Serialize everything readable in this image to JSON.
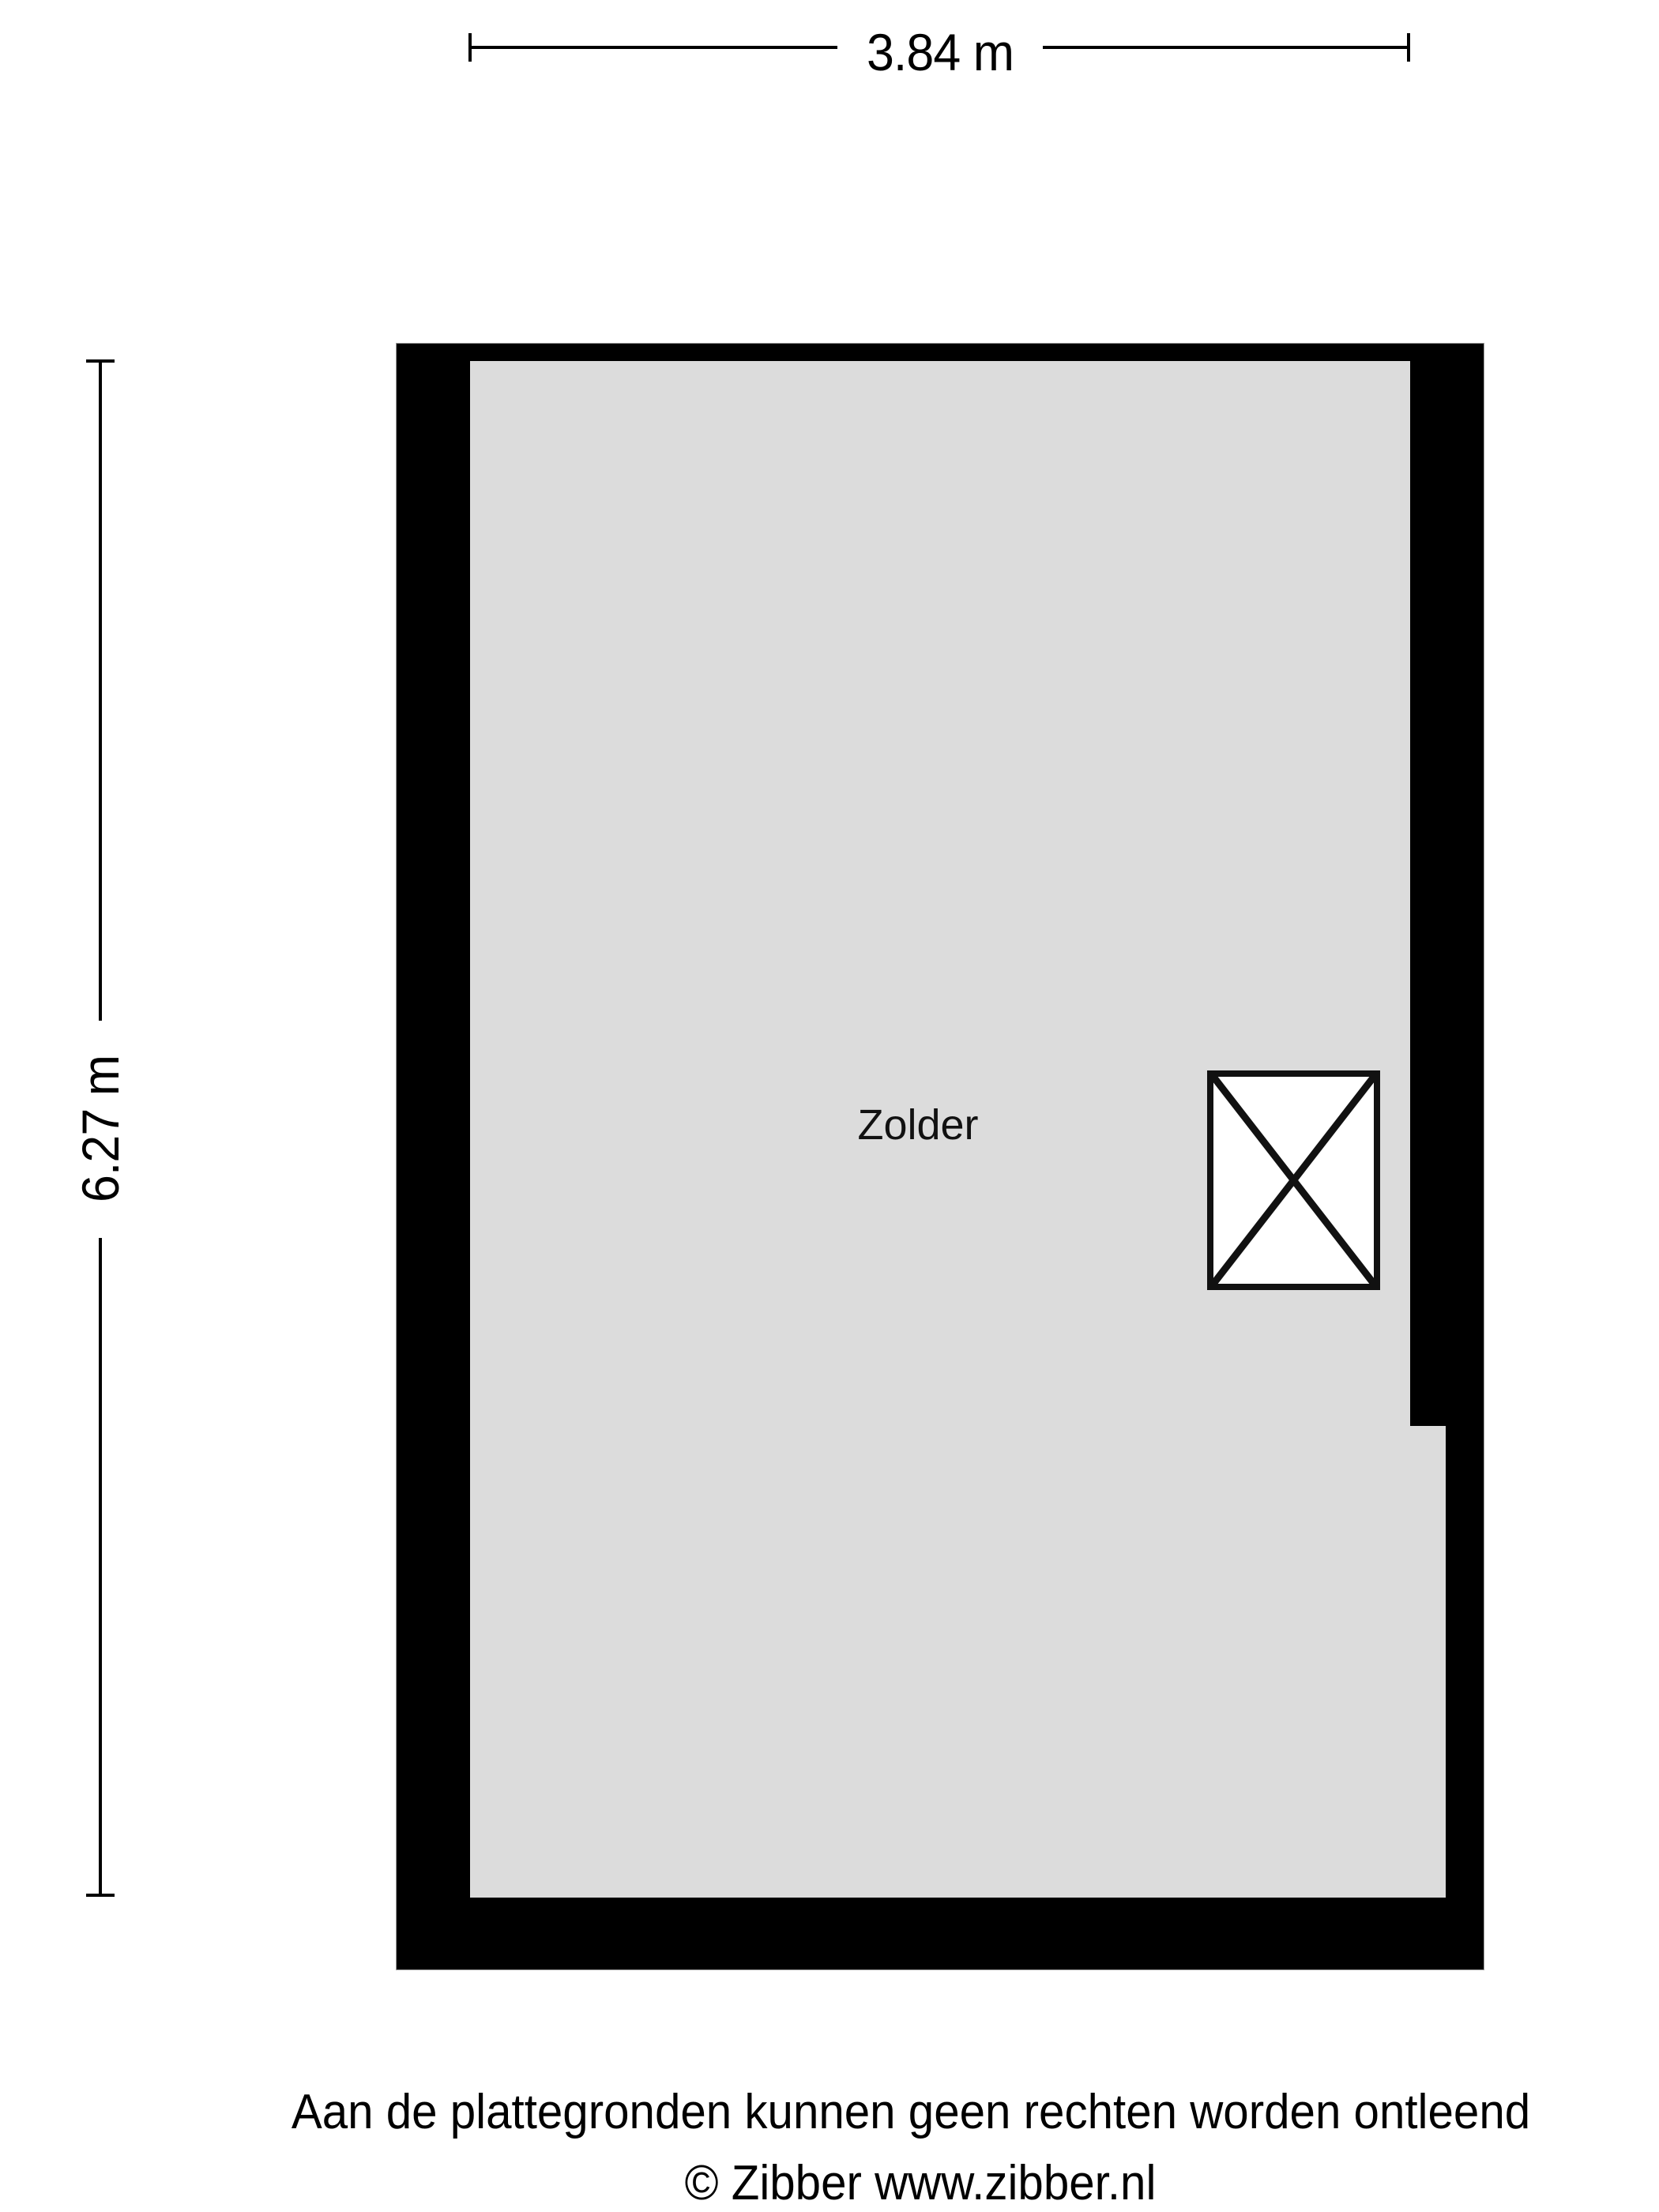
{
  "plan": {
    "room": {
      "label": "Zolder"
    },
    "symbols": {
      "void_box": "crossed-box-void-icon"
    },
    "colors": {
      "wall": "#000000",
      "floor": "#dcdcdc",
      "background": "#ffffff",
      "lines": "#000000"
    }
  },
  "dimensions": {
    "width_label": "3.84 m",
    "height_label": "6.27 m"
  },
  "footer": {
    "disclaimer": "Aan de plattegronden kunnen geen rechten worden ontleend",
    "copyright": "© Zibber www.zibber.nl"
  }
}
